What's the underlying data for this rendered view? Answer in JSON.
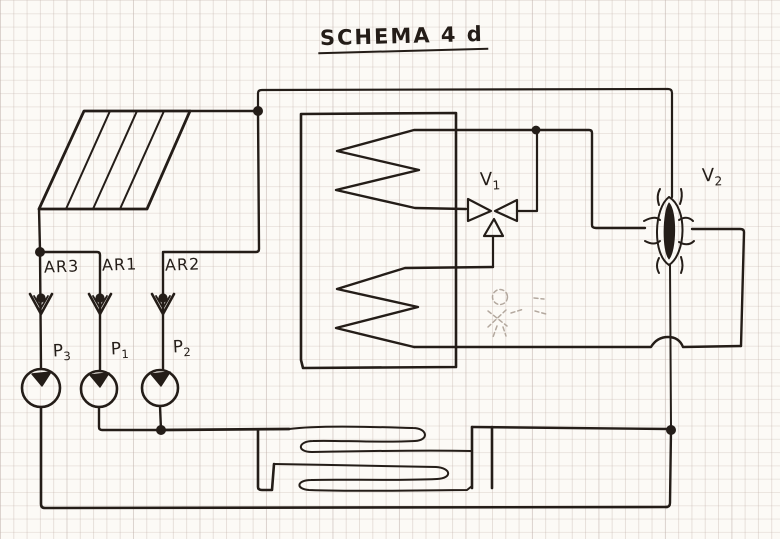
{
  "title": {
    "text": "SCHEMA 4 d"
  },
  "labels": {
    "ar3": "AR3",
    "ar1": "AR1",
    "ar2": "AR2",
    "p3": {
      "base": "P",
      "sub": "3"
    },
    "p1": {
      "base": "P",
      "sub": "1"
    },
    "p2": {
      "base": "P",
      "sub": "2"
    },
    "v1": {
      "base": "V",
      "sub": "1"
    },
    "v2": {
      "base": "V",
      "sub": "2"
    }
  },
  "symbols": {
    "solar-collector": "hatched parallelogram panel, top-left",
    "check-valve": "V glyph with filled dot, used for AR3 / AR1 / AR2",
    "pump": "circle with filled triangle, used for P3 / P1 / P2",
    "storage-tank": "large rectangle with two zigzag coils",
    "three-way-valve": "bowtie with bottom triangle, V1",
    "four-way-valve": "vertical almond with dark core, V2",
    "floor-serpentine": "double snake coil at bottom centre",
    "junction-dot": "filled circle pipe junction",
    "ghost-valve-sketch": "faint dashed erased valve under V1",
    "crossover-hop": "bump where bottom-right pipe crosses vertical pipe"
  },
  "colors": {
    "ink": "#241d18",
    "paper": "#fcfaf6",
    "grid": "#d9cec8",
    "faint_pencil": "#b3a89e"
  }
}
